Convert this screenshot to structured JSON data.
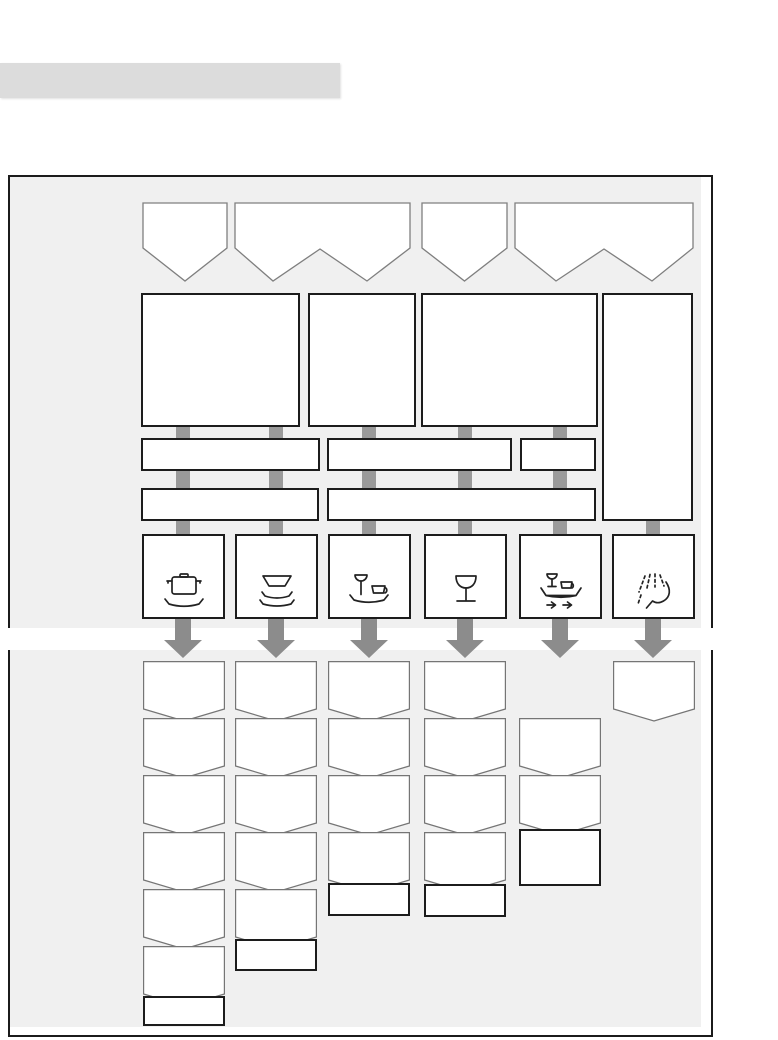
{
  "palette": {
    "page_bg": "#ffffff",
    "panel_bg": "#f0f0f0",
    "panel_border": "#1b1b1b",
    "header_bar": "#dcdcdc",
    "shape_fill": "#ffffff",
    "banner_border": "#7f7f7f",
    "card_border": "#757575",
    "box_border": "#1c1c1c",
    "connector": "#9a9a9a",
    "arrow": "#8c8c8c",
    "icon_stroke": "#222222"
  },
  "header_bar": {
    "x": 0,
    "y": 63,
    "width": 340,
    "height": 35
  },
  "panel": {
    "x": 8,
    "y": 175,
    "width": 705,
    "height": 862,
    "border_width": 2,
    "fill_inset": {
      "top": 0,
      "left": 0,
      "right": 10,
      "bottom": 8
    }
  },
  "white_stripe": {
    "y": 628,
    "height": 22
  },
  "diagram": {
    "banner_y": 202,
    "banner_straight": 46,
    "banner_vdepth": 33,
    "top_banners": [
      {
        "x": 142,
        "w": 86,
        "type": "v"
      },
      {
        "x": 234,
        "w": 177,
        "type": "w",
        "v1": 39,
        "peak": 86,
        "v2": 133
      },
      {
        "x": 421,
        "w": 87,
        "type": "v"
      },
      {
        "x": 514,
        "w": 180,
        "type": "w",
        "v1": 42,
        "peak": 90,
        "v2": 138
      }
    ],
    "big_boxes": [
      {
        "x": 141,
        "y": 293,
        "w": 159,
        "h": 134
      },
      {
        "x": 308,
        "y": 293,
        "w": 108,
        "h": 134
      },
      {
        "x": 421,
        "y": 293,
        "w": 177,
        "h": 134
      },
      {
        "x": 602,
        "y": 293,
        "w": 91,
        "h": 228
      }
    ],
    "option_bars": [
      {
        "x": 141,
        "y": 438,
        "w": 179,
        "h": 33
      },
      {
        "x": 327,
        "y": 438,
        "w": 185,
        "h": 33
      },
      {
        "x": 520,
        "y": 438,
        "w": 76,
        "h": 33
      },
      {
        "x": 141,
        "y": 488,
        "w": 178,
        "h": 33
      },
      {
        "x": 327,
        "y": 488,
        "w": 269,
        "h": 33
      }
    ],
    "connectors": {
      "width": 14,
      "rows": [
        {
          "y": 427,
          "h": 11,
          "cols": [
            183,
            276,
            369,
            465,
            560
          ]
        },
        {
          "y": 471,
          "h": 17,
          "cols": [
            183,
            276,
            369,
            465,
            560
          ]
        },
        {
          "y": 521,
          "h": 13,
          "cols": [
            183,
            276,
            369,
            465,
            560,
            653
          ]
        }
      ]
    },
    "icon_box_y": 534,
    "icon_box_w": 83,
    "icon_box_h": 85,
    "icon_boxes": [
      {
        "x": 142,
        "icon": "pot-icon"
      },
      {
        "x": 235,
        "icon": "bowls-icon"
      },
      {
        "x": 328,
        "icon": "glass-and-cup-icon"
      },
      {
        "x": 424,
        "icon": "wine-glass-icon"
      },
      {
        "x": 519,
        "icon": "tray-arrows-icon"
      },
      {
        "x": 612,
        "icon": "spray-icon"
      }
    ],
    "arrows": {
      "y": 619,
      "h": 39,
      "shaft_w": 16,
      "head_w": 38,
      "head_h": 18,
      "cols": [
        183,
        276,
        369,
        465,
        560,
        653
      ]
    },
    "stack_card": {
      "w": 82,
      "straight": 48,
      "vdepth": 12,
      "pitch": 57
    },
    "stacks": [
      {
        "x": 143,
        "first_y": 661,
        "pentagons": 6,
        "rect": {
          "y": 996,
          "h": 30
        }
      },
      {
        "x": 235,
        "first_y": 661,
        "pentagons": 5,
        "rect": {
          "y": 939,
          "h": 32
        }
      },
      {
        "x": 328,
        "first_y": 661,
        "pentagons": 4,
        "rect": {
          "y": 883,
          "h": 33
        }
      },
      {
        "x": 424,
        "first_y": 661,
        "pentagons": 4,
        "rect": {
          "y": 884,
          "h": 33
        }
      },
      {
        "x": 519,
        "first_y": 718,
        "pentagons": 2,
        "rect": {
          "y": 829,
          "h": 57
        }
      },
      {
        "x": 613,
        "first_y": 661,
        "pentagons": 1,
        "rect": null
      }
    ]
  }
}
